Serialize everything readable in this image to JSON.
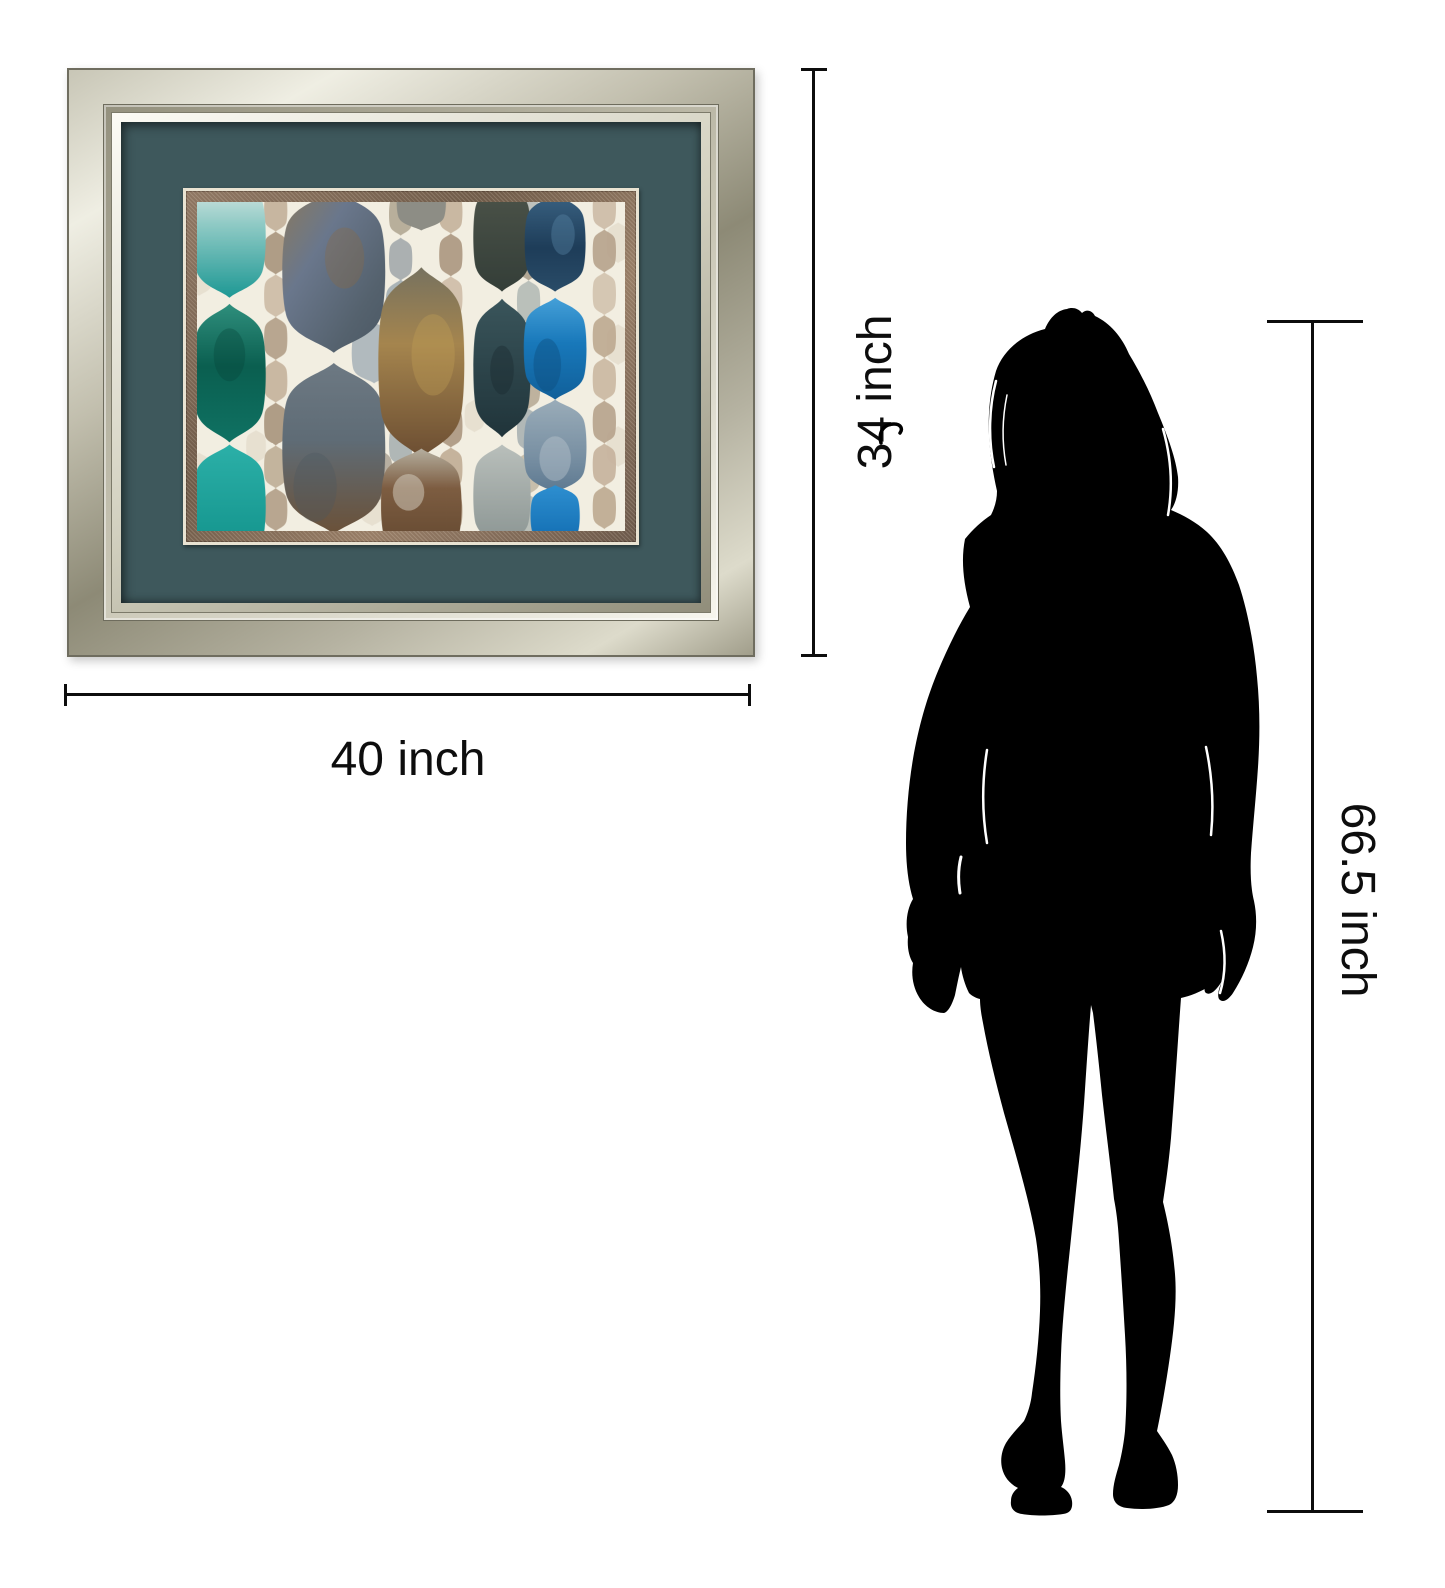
{
  "diagram": {
    "type": "product-size-comparison",
    "background_hex": "#ffffff",
    "dimension_line_color_hex": "#0d0d0d",
    "framed_art": {
      "width_label": "40 inch",
      "height_label": "34 inch",
      "frame_finish": "champagne-silver",
      "mat_color_hex": "#3e585c",
      "fillet_color_hex": "#7c6553",
      "art_background_hex": "#f2eee1",
      "art_style": "watercolor moroccan ogee drop pattern",
      "art_palette": [
        "#1d9894",
        "#0b5f50",
        "#0f8f88",
        "#6a778c",
        "#8a7a5e",
        "#5f6c76",
        "#6b5138",
        "#a5854e",
        "#6b4d32",
        "#4d544a",
        "#2e474c",
        "#a3aaa9",
        "#1e3d59",
        "#1878ba",
        "#7990a3",
        "#c0ad97"
      ]
    },
    "person": {
      "height_label": "66.5 inch",
      "silhouette_color_hex": "#000000"
    }
  }
}
